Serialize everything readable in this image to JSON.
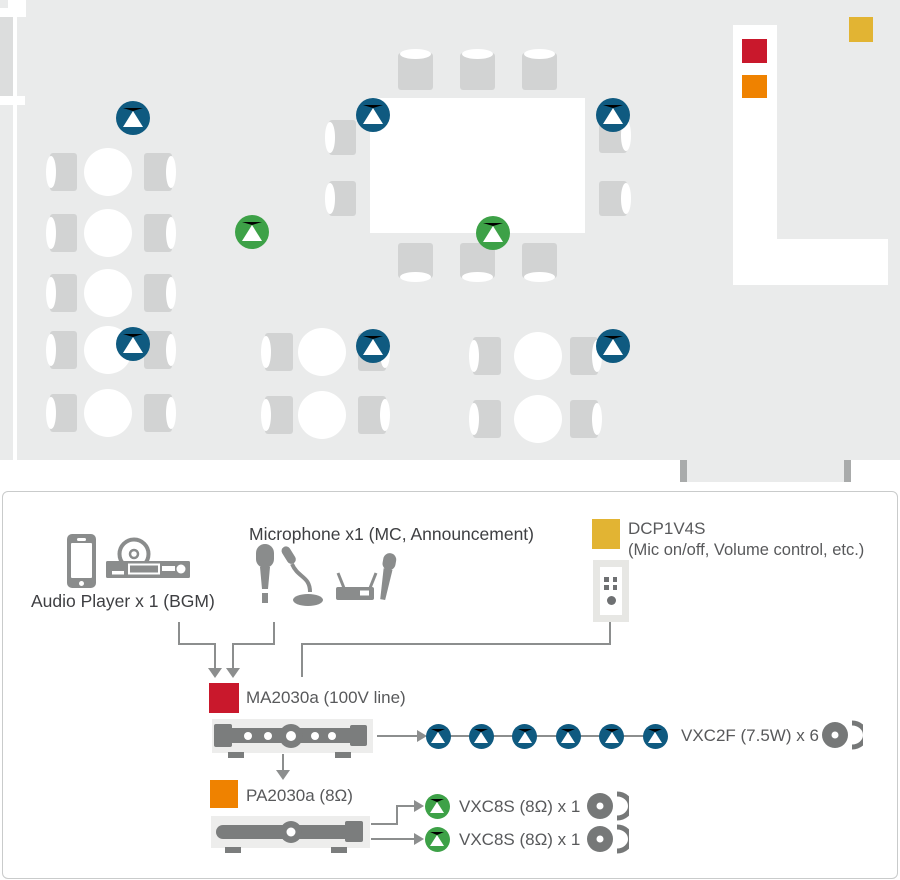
{
  "colors": {
    "blue": "#0f5a80",
    "green": "#3da147",
    "red": "#c9182c",
    "orange": "#ef8200",
    "yellow": "#e2b433",
    "floor": "#eaebeb",
    "line": "#8c8e8e",
    "icon_gray": "#8a8c8c"
  },
  "floor_plan": {
    "ceiling_speakers_blue": [
      {
        "x": 133,
        "y": 118
      },
      {
        "x": 373,
        "y": 115
      },
      {
        "x": 613,
        "y": 115
      },
      {
        "x": 133,
        "y": 344
      },
      {
        "x": 373,
        "y": 346
      },
      {
        "x": 613,
        "y": 346
      }
    ],
    "surface_speakers_green": [
      {
        "x": 252,
        "y": 232
      },
      {
        "x": 493,
        "y": 233
      }
    ],
    "wall_controller_yellow": {
      "x": 849,
      "y": 17,
      "w": 24,
      "h": 25
    },
    "amp_red": {
      "x": 742,
      "y": 39,
      "w": 25,
      "h": 24
    },
    "amp_orange": {
      "x": 742,
      "y": 75,
      "w": 25,
      "h": 23
    },
    "round_tables": [
      {
        "x": 108,
        "y": 172
      },
      {
        "x": 108,
        "y": 233
      },
      {
        "x": 108,
        "y": 293
      },
      {
        "x": 108,
        "y": 350
      },
      {
        "x": 108,
        "y": 413
      },
      {
        "x": 322,
        "y": 352
      },
      {
        "x": 322,
        "y": 415
      },
      {
        "x": 538,
        "y": 356
      },
      {
        "x": 538,
        "y": 419
      }
    ],
    "rect_table": {
      "x": 370,
      "y": 98,
      "w": 215,
      "h": 135
    },
    "chairs": [
      {
        "x": 50,
        "y": 153,
        "w": 27,
        "h": 38,
        "f": "r"
      },
      {
        "x": 144,
        "y": 153,
        "w": 28,
        "h": 38,
        "f": "l"
      },
      {
        "x": 50,
        "y": 214,
        "w": 27,
        "h": 38,
        "f": "r"
      },
      {
        "x": 144,
        "y": 214,
        "w": 28,
        "h": 38,
        "f": "l"
      },
      {
        "x": 50,
        "y": 274,
        "w": 27,
        "h": 38,
        "f": "r"
      },
      {
        "x": 144,
        "y": 274,
        "w": 28,
        "h": 38,
        "f": "l"
      },
      {
        "x": 50,
        "y": 331,
        "w": 27,
        "h": 38,
        "f": "r"
      },
      {
        "x": 144,
        "y": 331,
        "w": 28,
        "h": 38,
        "f": "l"
      },
      {
        "x": 50,
        "y": 394,
        "w": 27,
        "h": 38,
        "f": "r"
      },
      {
        "x": 144,
        "y": 394,
        "w": 28,
        "h": 38,
        "f": "l"
      },
      {
        "x": 265,
        "y": 333,
        "w": 28,
        "h": 38,
        "f": "r"
      },
      {
        "x": 358,
        "y": 333,
        "w": 28,
        "h": 38,
        "f": "l"
      },
      {
        "x": 265,
        "y": 396,
        "w": 28,
        "h": 38,
        "f": "r"
      },
      {
        "x": 358,
        "y": 396,
        "w": 28,
        "h": 38,
        "f": "l"
      },
      {
        "x": 473,
        "y": 337,
        "w": 28,
        "h": 38,
        "f": "r"
      },
      {
        "x": 570,
        "y": 337,
        "w": 28,
        "h": 38,
        "f": "l"
      },
      {
        "x": 473,
        "y": 400,
        "w": 28,
        "h": 38,
        "f": "r"
      },
      {
        "x": 570,
        "y": 400,
        "w": 28,
        "h": 38,
        "f": "l"
      },
      {
        "x": 398,
        "y": 53,
        "w": 35,
        "h": 37,
        "f": "b"
      },
      {
        "x": 460,
        "y": 53,
        "w": 35,
        "h": 37,
        "f": "b"
      },
      {
        "x": 522,
        "y": 53,
        "w": 35,
        "h": 37,
        "f": "b"
      },
      {
        "x": 398,
        "y": 243,
        "w": 35,
        "h": 35,
        "f": "t"
      },
      {
        "x": 460,
        "y": 243,
        "w": 35,
        "h": 35,
        "f": "t"
      },
      {
        "x": 522,
        "y": 243,
        "w": 35,
        "h": 35,
        "f": "t"
      },
      {
        "x": 329,
        "y": 120,
        "w": 27,
        "h": 35,
        "f": "r"
      },
      {
        "x": 329,
        "y": 181,
        "w": 27,
        "h": 35,
        "f": "r"
      },
      {
        "x": 599,
        "y": 118,
        "w": 28,
        "h": 35,
        "f": "l"
      },
      {
        "x": 599,
        "y": 181,
        "w": 28,
        "h": 35,
        "f": "l"
      }
    ]
  },
  "diagram": {
    "audio_player": {
      "label": "Audio Player x 1 (BGM)"
    },
    "microphone": {
      "label": "Microphone x1 (MC, Announcement)"
    },
    "dcp": {
      "model": "DCP1V4S",
      "desc": "(Mic on/off, Volume control, etc.)"
    },
    "ma_amp": {
      "label": "MA2030a (100V line)"
    },
    "pa_amp": {
      "label": "PA2030a (8Ω)"
    },
    "vxc2f": {
      "label": "VXC2F (7.5W) x 6",
      "count": 6
    },
    "vxc8s": [
      {
        "label": "VXC8S (8Ω) x 1"
      },
      {
        "label": "VXC8S (8Ω) x 1"
      }
    ]
  }
}
